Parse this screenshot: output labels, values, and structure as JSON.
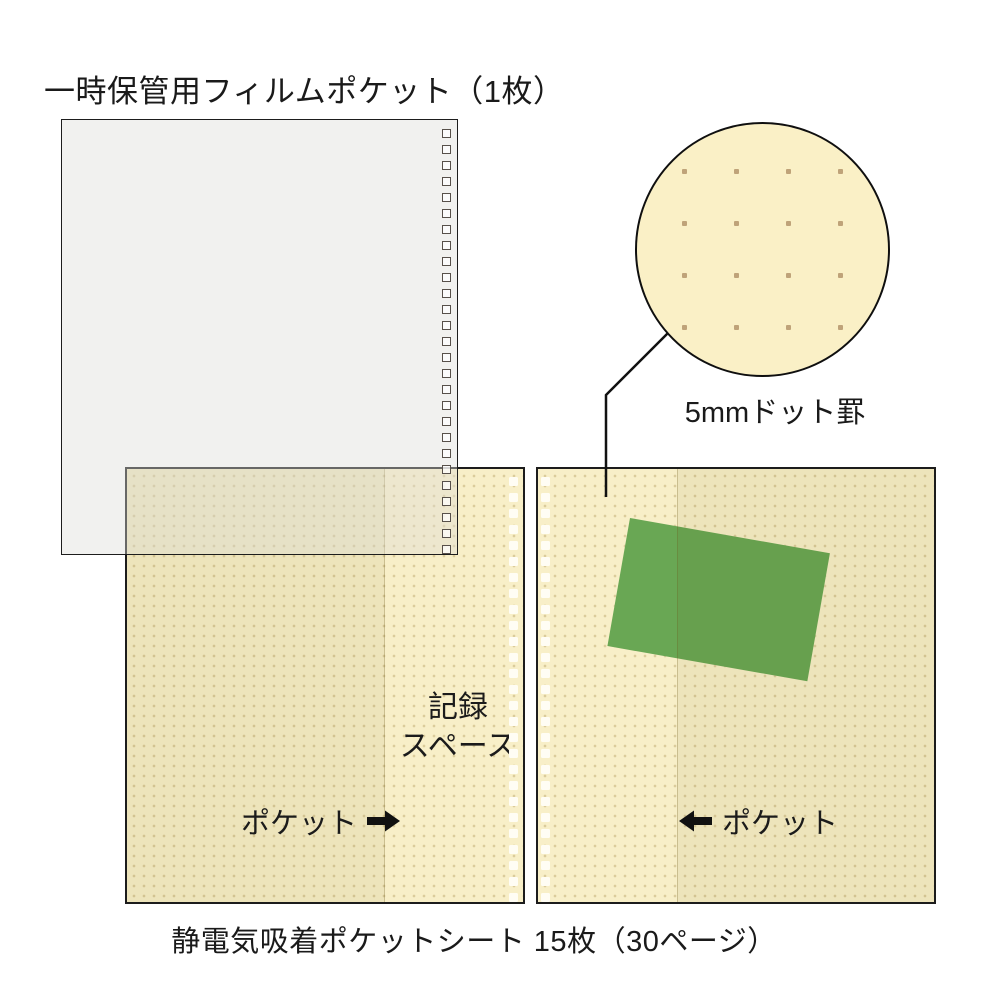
{
  "diagram": {
    "film_pocket": {
      "title": "一時保管用フィルムポケット（1枚）"
    },
    "magnifier": {
      "label": "5mmドット罫"
    },
    "left_page": {
      "recording_space": [
        "記録",
        "スペース"
      ],
      "pocket_label": "ポケット"
    },
    "right_page": {
      "pocket_label": "ポケット"
    },
    "caption": "静電気吸着ポケットシート 15枚（30ページ）",
    "colors": {
      "page_base": "#f8efc8",
      "pocket_shade": "#f0e5ba",
      "film_gray": "#f2f2f1",
      "photo_green": "#69a754",
      "grid_dot": "#bfa379",
      "line_black": "#1a1a1a"
    }
  }
}
